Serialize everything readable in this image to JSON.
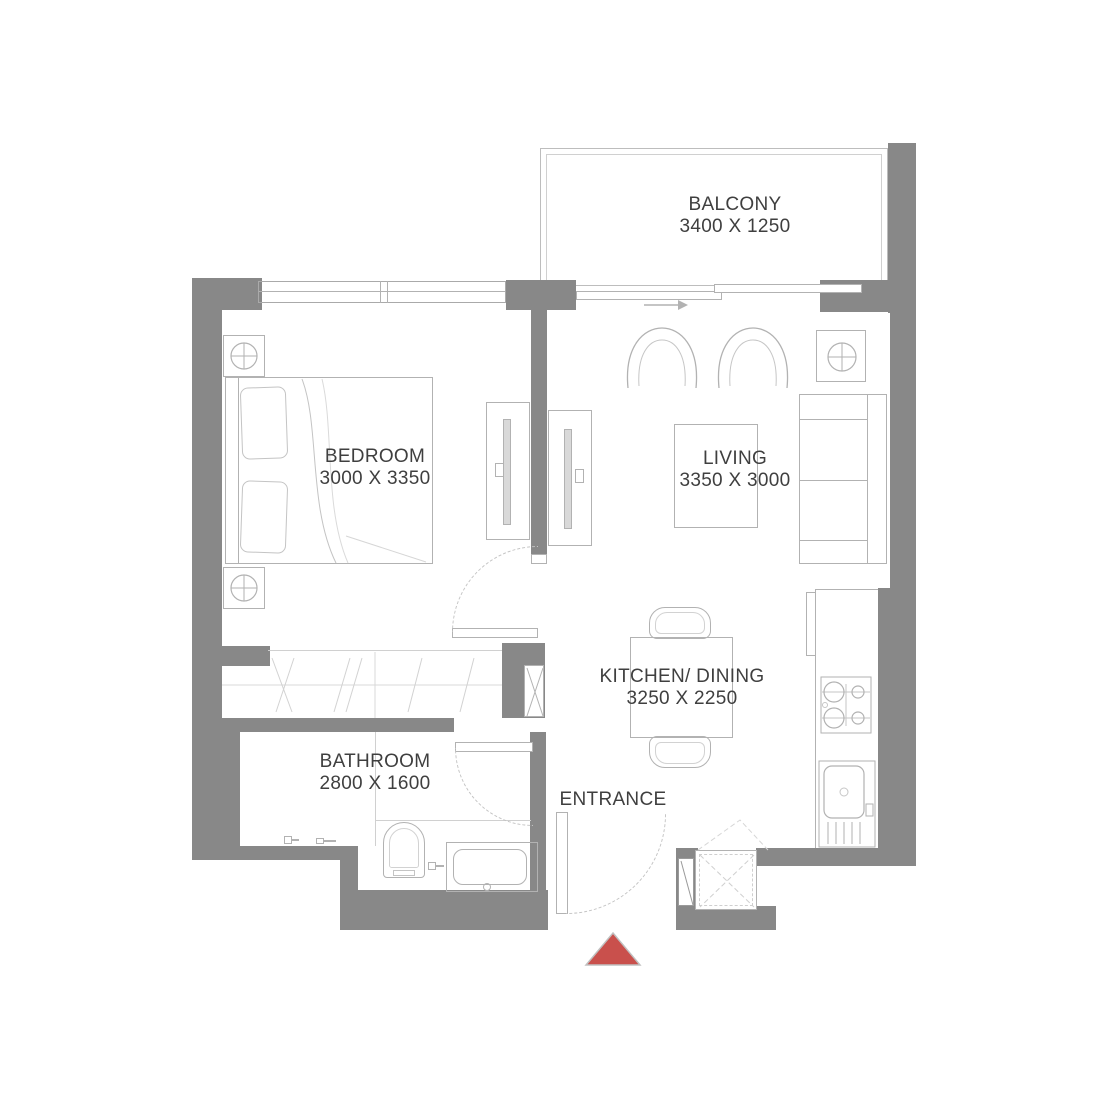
{
  "rooms": {
    "balcony": {
      "name": "BALCONY",
      "size": "3400 X 1250"
    },
    "bedroom": {
      "name": "BEDROOM",
      "size": "3000 X 3350"
    },
    "living": {
      "name": "LIVING",
      "size": "3350 X 3000"
    },
    "kitchen_dining": {
      "name": "KITCHEN/ DINING",
      "size": "3250 X 2250"
    },
    "bathroom": {
      "name": "BATHROOM",
      "size": "2800 X 1600"
    }
  },
  "labels": {
    "entrance": "ENTRANCE"
  },
  "icons": {
    "lamp": "circle-with-crosshair",
    "stove": "four-burner-hob",
    "sink": "bowl-with-drainboard",
    "shaft": "dashed-x-box",
    "duct": "x-box",
    "entrance_marker": "red-triangle",
    "direction_arrow": "right-arrow"
  },
  "colors": {
    "wall": "#888888",
    "furniture_line": "#b2b2b2",
    "faint_line": "#d0d0d0",
    "text": "#3f3f3f",
    "entrance_marker": "#c9504c",
    "door_arc": "#c4c4c4"
  }
}
